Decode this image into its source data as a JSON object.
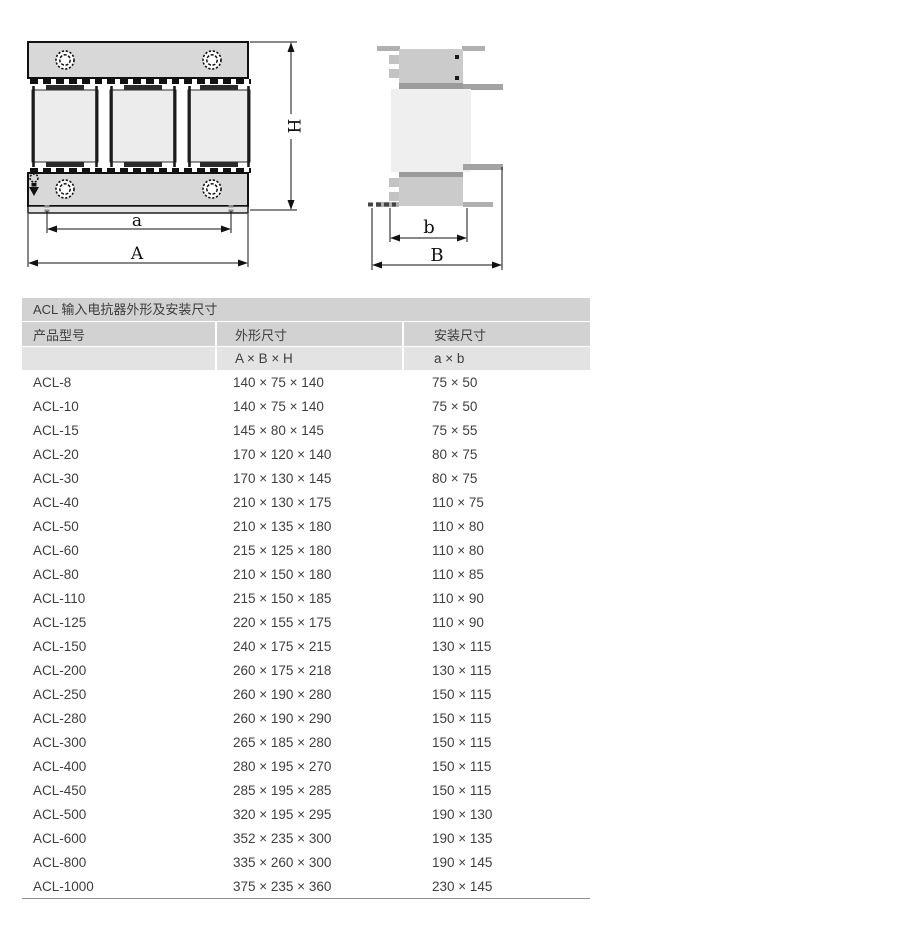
{
  "drawings": {
    "front_view": {
      "labels": {
        "height": "H",
        "mount_width": "a",
        "overall_width": "A"
      }
    },
    "side_view": {
      "labels": {
        "mount_depth": "b",
        "overall_depth": "B"
      }
    }
  },
  "table": {
    "title": "ACL 输入电抗器外形及安装尺寸",
    "columns": {
      "model": "产品型号",
      "outline": "外形尺寸",
      "mount": "安装尺寸"
    },
    "subcolumns": {
      "outline": "A × B × H",
      "mount": "a × b"
    },
    "rows": [
      {
        "model": "ACL-8",
        "outline": "140 × 75 × 140",
        "mount": "75 × 50"
      },
      {
        "model": "ACL-10",
        "outline": "140 × 75 × 140",
        "mount": "75 × 50"
      },
      {
        "model": "ACL-15",
        "outline": "145 × 80 × 145",
        "mount": "75 × 55"
      },
      {
        "model": "ACL-20",
        "outline": "170 × 120 × 140",
        "mount": "80 × 75"
      },
      {
        "model": "ACL-30",
        "outline": "170 × 130 × 145",
        "mount": "80 × 75"
      },
      {
        "model": "ACL-40",
        "outline": "210 × 130 × 175",
        "mount": "110 × 75"
      },
      {
        "model": "ACL-50",
        "outline": "210 × 135 × 180",
        "mount": "110 × 80"
      },
      {
        "model": "ACL-60",
        "outline": "215 × 125 × 180",
        "mount": "110 × 80"
      },
      {
        "model": "ACL-80",
        "outline": "210 × 150 × 180",
        "mount": "110 × 85"
      },
      {
        "model": "ACL-110",
        "outline": "215 × 150 × 185",
        "mount": "110 × 90"
      },
      {
        "model": "ACL-125",
        "outline": "220 × 155 × 175",
        "mount": "110 × 90"
      },
      {
        "model": "ACL-150",
        "outline": "240 × 175 × 215",
        "mount": "130 × 115"
      },
      {
        "model": "ACL-200",
        "outline": "260 × 175 × 218",
        "mount": "130 × 115"
      },
      {
        "model": "ACL-250",
        "outline": "260 × 190 × 280",
        "mount": "150 × 115"
      },
      {
        "model": "ACL-280",
        "outline": "260 × 190 × 290",
        "mount": "150 × 115"
      },
      {
        "model": "ACL-300",
        "outline": "265 × 185 × 280",
        "mount": "150 × 115"
      },
      {
        "model": "ACL-400",
        "outline": "280 × 195 × 270",
        "mount": "150 × 115"
      },
      {
        "model": "ACL-450",
        "outline": "285 × 195 × 285",
        "mount": "150 × 115"
      },
      {
        "model": "ACL-500",
        "outline": "320 × 195 × 295",
        "mount": "190 × 130"
      },
      {
        "model": "ACL-600",
        "outline": "352 × 235 × 300",
        "mount": "190 × 135"
      },
      {
        "model": "ACL-800",
        "outline": "335 × 260 × 300",
        "mount": "190 × 145"
      },
      {
        "model": "ACL-1000",
        "outline": "375 × 235 × 360",
        "mount": "230 × 145"
      }
    ]
  },
  "colors": {
    "table_header_bg": "#d2d2d2",
    "table_subheader_bg": "#e3e3e3",
    "text": "#3f3f3f",
    "drawing_stroke": "#111111",
    "clamp_fill": "#d8d8d8",
    "coil_fill": "#ececec"
  }
}
